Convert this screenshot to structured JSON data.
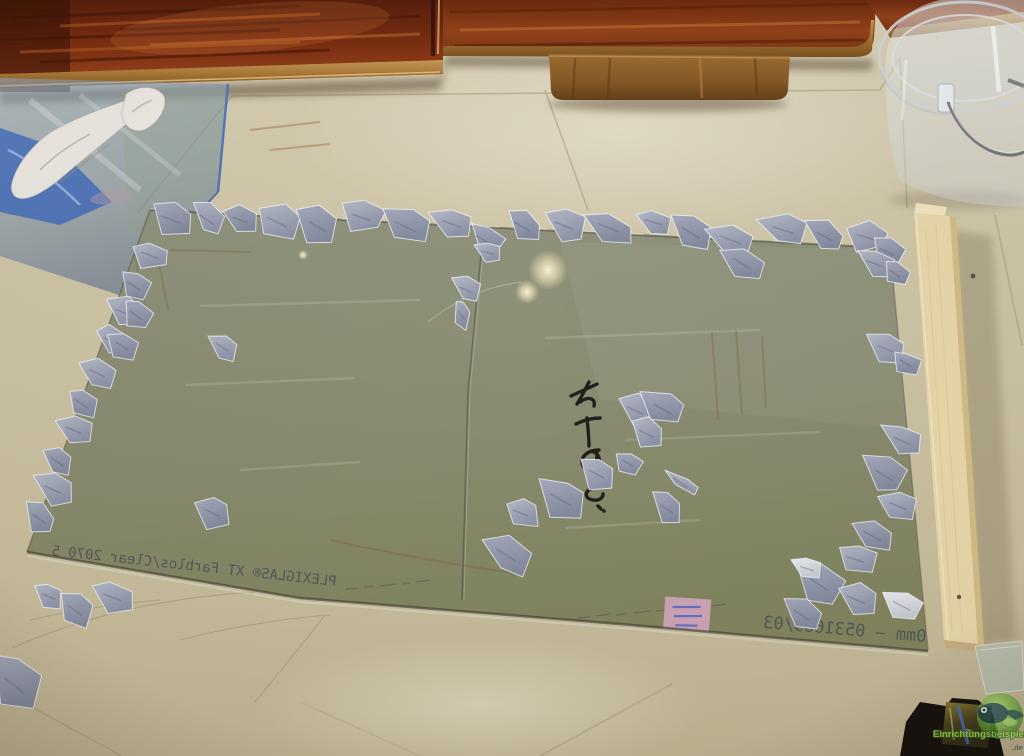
{
  "meta": {
    "description": "Photograph: a large PLEXIGLAS XT acrylic sheet lying on a beige tiled floor, its edges weighted with small grey broken-glass/stone chips; dark wooden sideboard above, clear plastic bucket and pine plank on the right, blue glass pane with tissue at top left, black case and watermark bottom right."
  },
  "texts": {
    "sheet_print_main": "PLEXIGLAS® XT Farblos/Clear 2070   5",
    "sheet_print_batch": "0mm — 0531609/03",
    "watermark_name": "Einrichtungsbeispiele",
    "watermark_tld": ".de"
  },
  "colors": {
    "floor_light": "#d8cfb4",
    "floor_mid": "#cdc3a4",
    "floor_dark": "#c2b794",
    "wood_dark": "#4a1a0a",
    "wood_mid": "#7c2f12",
    "wood_light": "#a84e20",
    "wood_trim": "#b9884a",
    "foot_wood": "#8f6229",
    "sheet_film": "#8b8e74",
    "fragment_grey": "#9ba0b2",
    "plank_face": "#e9d8ab",
    "plank_side": "#d5bd85",
    "plank_end": "#f1e5c0",
    "bucket_plastic": "#dfe3e6",
    "pane_blue": "#7d9cc4",
    "film_blue": "#2a5cc0",
    "tissue_white": "#ece8e2",
    "sticker_pink": "#d9aac6",
    "sticker_ink": "#4f63c8",
    "marker_ink": "#181818",
    "print_ink": "#3c4352",
    "case_black": "#17120e",
    "watermark_green": "#8fc83e"
  },
  "fragments": [
    [
      150,
      206,
      42,
      30,
      -4
    ],
    [
      192,
      204,
      34,
      28,
      6
    ],
    [
      224,
      210,
      30,
      24,
      -8
    ],
    [
      256,
      206,
      46,
      30,
      3
    ],
    [
      300,
      210,
      38,
      34,
      0
    ],
    [
      340,
      206,
      42,
      26,
      -5
    ],
    [
      383,
      210,
      48,
      30,
      4
    ],
    [
      432,
      212,
      40,
      26,
      -3
    ],
    [
      468,
      226,
      38,
      24,
      8
    ],
    [
      474,
      246,
      26,
      18,
      -10
    ],
    [
      506,
      212,
      36,
      26,
      5
    ],
    [
      543,
      212,
      42,
      30,
      -4
    ],
    [
      587,
      214,
      46,
      26,
      2
    ],
    [
      634,
      212,
      38,
      24,
      -6
    ],
    [
      672,
      216,
      42,
      30,
      5
    ],
    [
      708,
      226,
      46,
      30,
      -3
    ],
    [
      724,
      248,
      42,
      26,
      8
    ],
    [
      760,
      218,
      46,
      28,
      -5
    ],
    [
      806,
      222,
      40,
      26,
      4
    ],
    [
      846,
      226,
      38,
      26,
      -6
    ],
    [
      872,
      240,
      32,
      22,
      3
    ],
    [
      132,
      244,
      36,
      26,
      -5
    ],
    [
      120,
      272,
      32,
      24,
      7
    ],
    [
      106,
      300,
      36,
      28,
      -4
    ],
    [
      124,
      302,
      30,
      22,
      10
    ],
    [
      94,
      330,
      32,
      26,
      -8
    ],
    [
      110,
      334,
      28,
      22,
      5
    ],
    [
      80,
      360,
      34,
      28,
      -3
    ],
    [
      68,
      390,
      30,
      24,
      6
    ],
    [
      56,
      418,
      34,
      28,
      -6
    ],
    [
      44,
      448,
      30,
      26,
      4
    ],
    [
      34,
      476,
      36,
      30,
      -5
    ],
    [
      26,
      504,
      32,
      26,
      8
    ],
    [
      210,
      334,
      28,
      24,
      6
    ],
    [
      196,
      500,
      30,
      30,
      -8
    ],
    [
      856,
      252,
      38,
      26,
      -4
    ],
    [
      884,
      262,
      26,
      20,
      8
    ],
    [
      868,
      336,
      36,
      30,
      -6
    ],
    [
      894,
      352,
      26,
      20,
      5
    ],
    [
      884,
      428,
      34,
      28,
      -5
    ],
    [
      866,
      458,
      40,
      32,
      4
    ],
    [
      880,
      494,
      34,
      28,
      -7
    ],
    [
      854,
      520,
      40,
      30,
      3
    ],
    [
      836,
      548,
      38,
      26,
      -5
    ],
    [
      800,
      566,
      44,
      34,
      5
    ],
    [
      836,
      586,
      40,
      30,
      -4
    ],
    [
      786,
      600,
      36,
      26,
      7
    ],
    [
      618,
      398,
      34,
      28,
      -5
    ],
    [
      644,
      394,
      42,
      26,
      6
    ],
    [
      630,
      420,
      30,
      32,
      -8
    ],
    [
      616,
      452,
      26,
      20,
      5
    ],
    [
      580,
      460,
      32,
      30,
      -4
    ],
    [
      538,
      480,
      50,
      36,
      4
    ],
    [
      504,
      502,
      32,
      26,
      -7
    ],
    [
      486,
      536,
      44,
      36,
      3
    ],
    [
      666,
      470,
      38,
      11,
      24
    ],
    [
      653,
      494,
      26,
      32,
      -5
    ],
    [
      452,
      280,
      26,
      22,
      -6
    ],
    [
      456,
      302,
      16,
      24,
      10
    ],
    [
      34,
      586,
      28,
      24,
      -6
    ],
    [
      60,
      594,
      34,
      30,
      5
    ],
    [
      92,
      584,
      38,
      32,
      -8
    ],
    [
      -6,
      660,
      46,
      48,
      4
    ],
    [
      792,
      560,
      30,
      20,
      -5,
      1
    ],
    [
      884,
      592,
      40,
      24,
      6,
      1
    ]
  ]
}
